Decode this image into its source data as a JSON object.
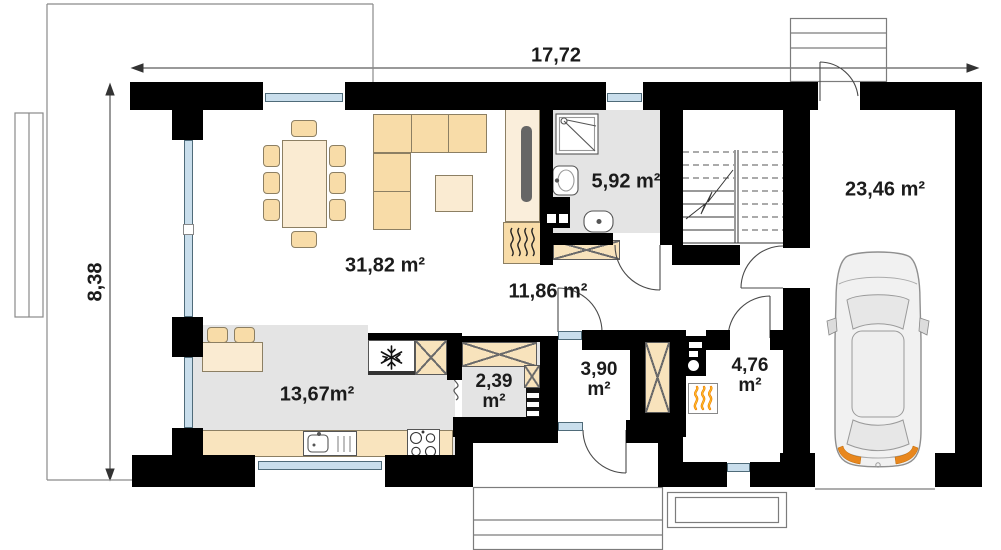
{
  "plan": {
    "title": "house ground floor plan",
    "dimensions": {
      "horizontal": "17,72",
      "vertical": "8,38"
    },
    "rooms": {
      "living": {
        "label": "31,82 m²"
      },
      "kitchen": {
        "label": "13,67m²"
      },
      "bathroom": {
        "label": "5,92 m²"
      },
      "hall": {
        "label": "11,86 m²"
      },
      "garage": {
        "label": "23,46 m²"
      },
      "closet": {
        "line1": "2,39",
        "line2": "m²"
      },
      "vestibule": {
        "line1": "3,90",
        "line2": "m²"
      },
      "boiler": {
        "line1": "4,76",
        "line2": "m²"
      }
    },
    "icons": {
      "fridge": "snowflake-icon",
      "furnace": "flame-icon",
      "fireplace": "steam-waves-icon",
      "stairs": "staircase-symbol",
      "garage_vehicle": "car-top-view"
    },
    "colors": {
      "wall": "#000000",
      "floor": "#E4E4E4",
      "furniture": "#F8DCA8",
      "furniture_light": "#FAEBD2",
      "glass": "#C9DEEC",
      "flame_orange": "#F07E00",
      "taillight_orange": "#E8871E"
    }
  }
}
